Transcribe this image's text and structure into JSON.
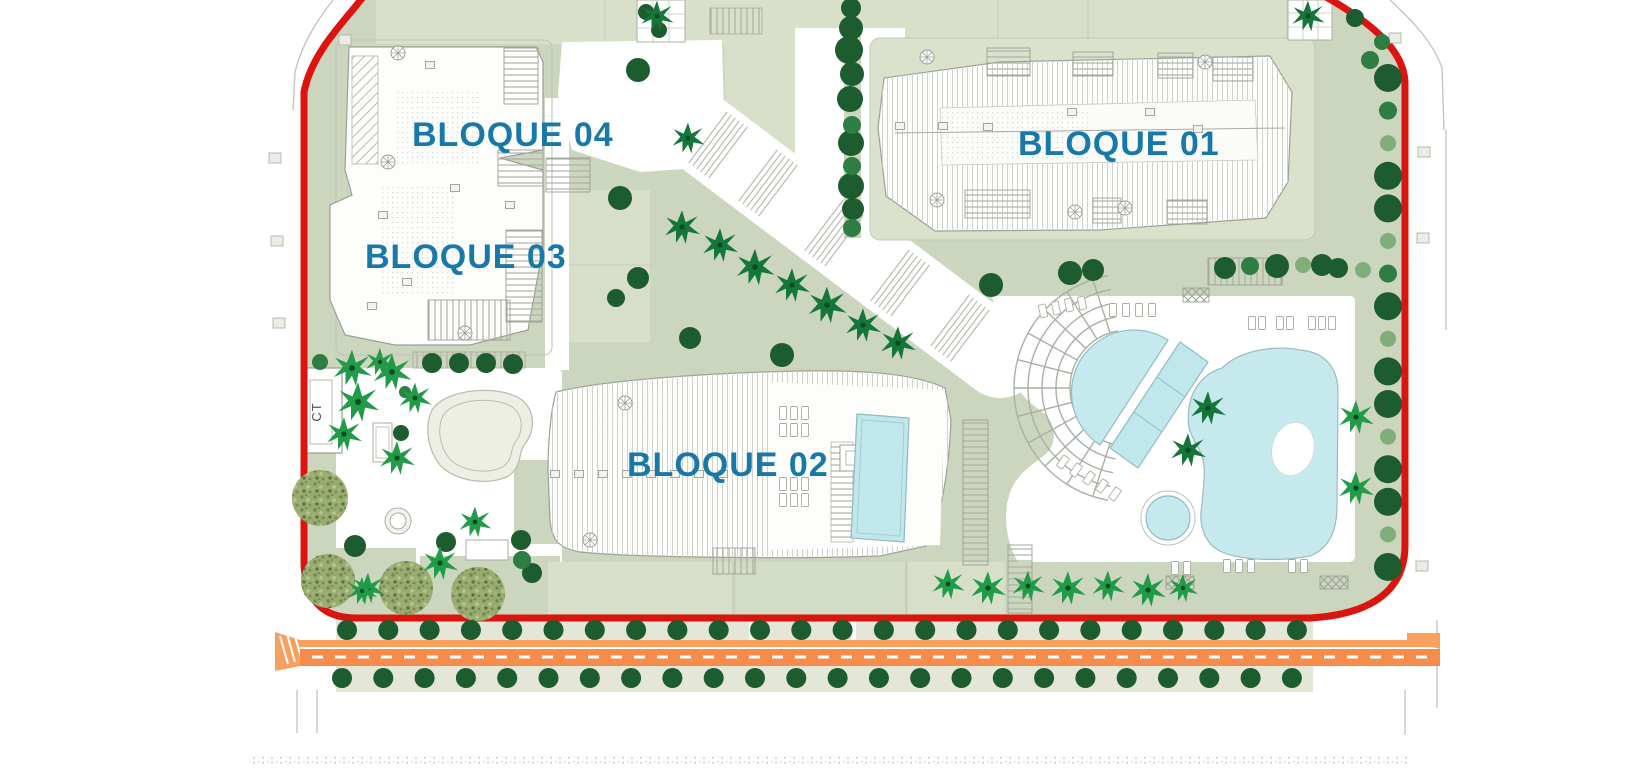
{
  "plan": {
    "type": "residential-site-plan",
    "labels": {
      "bloque01": "BLOQUE 01",
      "bloque02": "BLOQUE 02",
      "bloque03": "BLOQUE 03",
      "bloque04": "BLOQUE 04",
      "ct": "CT"
    },
    "colors": {
      "boundary_red": "#dc1410",
      "road_orange": "#f58c4b",
      "road_orange_light": "#f8a05f",
      "label_blue": "#1878a8",
      "sage": "#ccd5bd",
      "sage_light": "#d9e0ca",
      "pool_blue": "#c5e9ed",
      "tree_dark": "#1d5c2f",
      "tree_mid": "#2e7d43",
      "tree_light": "#7fae79",
      "palm_bright": "#219b48",
      "palm_dark": "#15763a",
      "olive": "#98ac70"
    },
    "vegetation": {
      "olives": [
        [
          320,
          498,
          28
        ],
        [
          328,
          581,
          27
        ],
        [
          406,
          588,
          27
        ],
        [
          478,
          594,
          27
        ]
      ],
      "dark_trees": [
        [
          851,
          8,
          10
        ],
        [
          851,
          28,
          12
        ],
        [
          849,
          50,
          14
        ],
        [
          852,
          74,
          12
        ],
        [
          850,
          99,
          13
        ],
        [
          851,
          143,
          13
        ],
        [
          851,
          186,
          13
        ],
        [
          853,
          209,
          11
        ],
        [
          646,
          12,
          8
        ],
        [
          659,
          30,
          8
        ],
        [
          638,
          70,
          12
        ],
        [
          620,
          198,
          12
        ],
        [
          638,
          278,
          11
        ],
        [
          616,
          298,
          9
        ],
        [
          690,
          338,
          11
        ],
        [
          782,
          355,
          12
        ],
        [
          355,
          546,
          11
        ],
        [
          446,
          542,
          10
        ],
        [
          521,
          540,
          10
        ],
        [
          532,
          573,
          10
        ],
        [
          432,
          363,
          10
        ],
        [
          459,
          363,
          10
        ],
        [
          486,
          363,
          10
        ],
        [
          513,
          364,
          10
        ],
        [
          991,
          285,
          12
        ],
        [
          1070,
          273,
          12
        ],
        [
          1093,
          270,
          11
        ],
        [
          1322,
          265,
          11
        ],
        [
          1338,
          268,
          10
        ],
        [
          1225,
          268,
          11
        ],
        [
          1277,
          266,
          12
        ],
        [
          1355,
          18,
          9
        ],
        [
          401,
          433,
          8
        ]
      ],
      "mid_trees": [
        [
          852,
          125,
          9
        ],
        [
          852,
          166,
          9
        ],
        [
          852,
          228,
          9
        ],
        [
          1250,
          266,
          9
        ],
        [
          320,
          362,
          8
        ],
        [
          522,
          560,
          9
        ],
        [
          1370,
          60,
          9
        ],
        [
          405,
          392,
          6
        ],
        [
          1382,
          42,
          8
        ]
      ],
      "light_trees": [
        [
          1303,
          265,
          8
        ],
        [
          1363,
          270,
          8
        ]
      ],
      "palms_bright": [
        [
          352,
          368,
          1.3
        ],
        [
          392,
          372,
          1.3
        ],
        [
          358,
          402,
          1.4
        ],
        [
          344,
          434,
          1.2
        ],
        [
          397,
          458,
          1.2
        ],
        [
          415,
          398,
          1.1
        ],
        [
          380,
          362,
          1.0
        ],
        [
          368,
          588,
          1.1
        ],
        [
          440,
          563,
          1.2
        ],
        [
          475,
          522,
          1.1
        ],
        [
          362,
          591,
          1.0
        ],
        [
          1356,
          417,
          1.2
        ],
        [
          1356,
          488,
          1.2
        ],
        [
          948,
          584,
          1.1
        ],
        [
          988,
          588,
          1.2
        ],
        [
          1028,
          586,
          1.1
        ],
        [
          1068,
          588,
          1.2
        ],
        [
          1108,
          586,
          1.1
        ],
        [
          1148,
          590,
          1.2
        ],
        [
          1183,
          588,
          1.0
        ]
      ],
      "palms_dark": [
        [
          682,
          227,
          1.2
        ],
        [
          720,
          245,
          1.2
        ],
        [
          755,
          267,
          1.3
        ],
        [
          792,
          285,
          1.2
        ],
        [
          827,
          305,
          1.3
        ],
        [
          863,
          325,
          1.2
        ],
        [
          898,
          343,
          1.2
        ],
        [
          657,
          16,
          1.1
        ],
        [
          1308,
          16,
          1.1
        ],
        [
          688,
          138,
          1.1
        ],
        [
          1208,
          408,
          1.2
        ],
        [
          1188,
          450,
          1.2
        ]
      ],
      "road_rows": {
        "above": {
          "y": 630,
          "x0": 347,
          "dx": 41.3,
          "n": 24,
          "r": 10
        },
        "below": {
          "y": 678,
          "x0": 342,
          "dx": 41.3,
          "n": 24,
          "r": 10
        }
      },
      "right_column": {
        "x": 1388,
        "y0": 78,
        "dy": 32.6,
        "n": 16
      }
    },
    "furniture": {
      "loungers": [
        [
          1113,
          310,
          0
        ],
        [
          1126,
          310,
          0
        ],
        [
          1139,
          310,
          0
        ],
        [
          1152,
          310,
          0
        ],
        [
          1043,
          311,
          -12
        ],
        [
          1056,
          308,
          -12
        ],
        [
          1069,
          305,
          -12
        ],
        [
          1082,
          303,
          -12
        ],
        [
          1252,
          323,
          0
        ],
        [
          1262,
          323,
          0
        ],
        [
          1280,
          323,
          0
        ],
        [
          1290,
          323,
          0
        ],
        [
          1312,
          323,
          0
        ],
        [
          1322,
          323,
          0
        ],
        [
          1332,
          323,
          0
        ],
        [
          1063,
          462,
          35
        ],
        [
          1076,
          470,
          35
        ],
        [
          1089,
          478,
          35
        ],
        [
          1102,
          486,
          35
        ],
        [
          1115,
          494,
          35
        ],
        [
          1175,
          568,
          0
        ],
        [
          1187,
          568,
          0
        ],
        [
          1227,
          566,
          0
        ],
        [
          1239,
          566,
          0
        ],
        [
          1251,
          566,
          0
        ],
        [
          1292,
          566,
          0
        ],
        [
          1304,
          566,
          0
        ],
        [
          783,
          413,
          0
        ],
        [
          794,
          413,
          0
        ],
        [
          805,
          413,
          0
        ],
        [
          783,
          430,
          0
        ],
        [
          794,
          430,
          0
        ],
        [
          805,
          430,
          0
        ],
        [
          783,
          484,
          0
        ],
        [
          794,
          484,
          0
        ],
        [
          805,
          484,
          0
        ],
        [
          783,
          500,
          0
        ],
        [
          794,
          500,
          0
        ],
        [
          805,
          500,
          0
        ]
      ],
      "roof_boxes": [
        [
          430,
          65
        ],
        [
          510,
          205
        ],
        [
          383,
          215
        ],
        [
          455,
          188
        ],
        [
          407,
          282
        ],
        [
          372,
          306
        ],
        [
          900,
          126
        ],
        [
          943,
          126
        ],
        [
          988,
          127
        ],
        [
          1072,
          112
        ],
        [
          1150,
          112
        ],
        [
          1198,
          129
        ],
        [
          555,
          474
        ],
        [
          579,
          474
        ],
        [
          603,
          474
        ],
        [
          627,
          474
        ],
        [
          651,
          474
        ],
        [
          675,
          474
        ],
        [
          699,
          474
        ],
        [
          723,
          474
        ]
      ],
      "outside_boxes": [
        [
          275,
          158
        ],
        [
          277,
          241
        ],
        [
          279,
          323
        ],
        [
          1395,
          38
        ],
        [
          1424,
          152
        ],
        [
          1423,
          238
        ],
        [
          1422,
          566
        ],
        [
          345,
          40
        ]
      ],
      "spirals": [
        [
          398,
          53
        ],
        [
          388,
          162
        ],
        [
          465,
          333
        ],
        [
          927,
          57
        ],
        [
          1205,
          62
        ],
        [
          937,
          200
        ],
        [
          1075,
          212
        ],
        [
          1125,
          208
        ],
        [
          625,
          403
        ],
        [
          590,
          540
        ]
      ]
    },
    "amphitheater": {
      "cx": 1128,
      "cy": 388,
      "r0": 58,
      "r1": 114,
      "rings": 5,
      "a0": 100,
      "a1": 260,
      "spokes": 11
    },
    "boulevard_stairs": {
      "angle": 37,
      "len": 64,
      "step": 5,
      "count": 6,
      "centers": [
        [
          718,
          145
        ],
        [
          768,
          183
        ],
        [
          834,
          233
        ],
        [
          900,
          283
        ],
        [
          960,
          328
        ]
      ]
    }
  }
}
